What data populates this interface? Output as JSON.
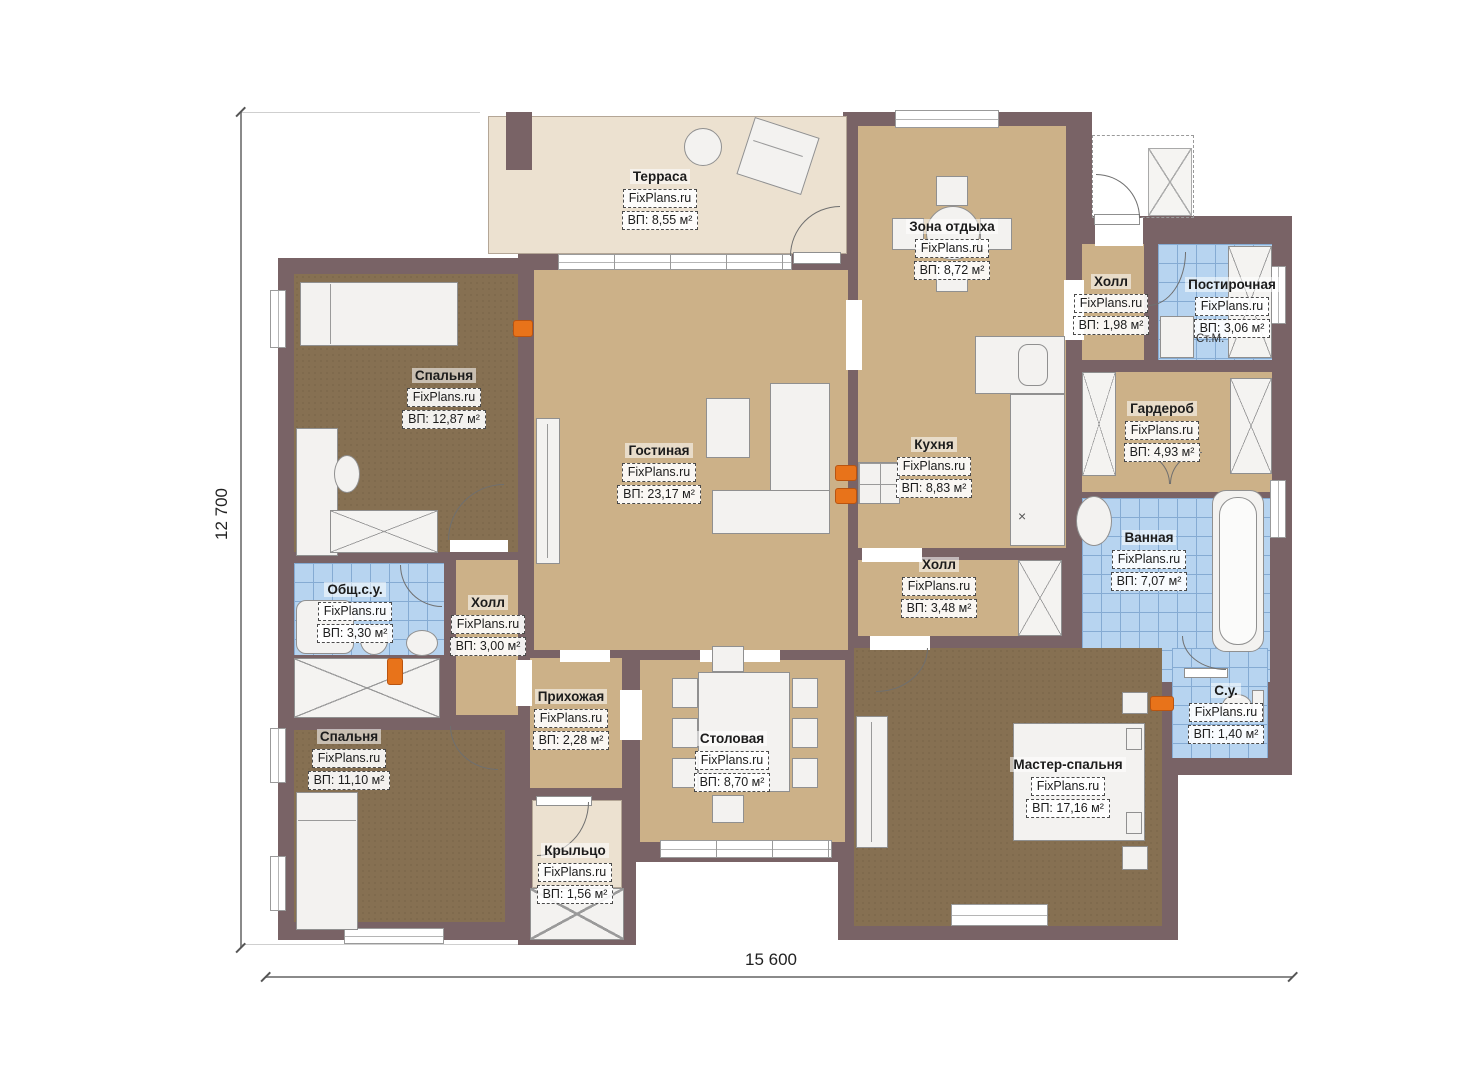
{
  "watermark": "FixPlans.ru",
  "dimensions": {
    "height": "12 700",
    "width": "15 600"
  },
  "annotations": {
    "washing_machine": "Ст.М."
  },
  "rooms": [
    {
      "name": "Терраса",
      "area": "ВП: 8,55 м²"
    },
    {
      "name": "Зона отдыха",
      "area": "ВП: 8,72 м²"
    },
    {
      "name": "Холл",
      "area": "ВП: 1,98 м²"
    },
    {
      "name": "Постирочная",
      "area": "ВП: 3,06 м²"
    },
    {
      "name": "Гардероб",
      "area": "ВП: 4,93 м²"
    },
    {
      "name": "Ванная",
      "area": "ВП: 7,07 м²"
    },
    {
      "name": "С.у.",
      "area": "ВП: 1,40 м²"
    },
    {
      "name": "Кухня",
      "area": "ВП: 8,83 м²"
    },
    {
      "name": "Холл",
      "area": "ВП: 3,48 м²"
    },
    {
      "name": "Гостиная",
      "area": "ВП: 23,17 м²"
    },
    {
      "name": "Спальня",
      "area": "ВП: 12,87 м²"
    },
    {
      "name": "Общ.с.у.",
      "area": "ВП: 3,30 м²"
    },
    {
      "name": "Холл",
      "area": "ВП: 3,00 м²"
    },
    {
      "name": "Спальня",
      "area": "ВП: 11,10 м²"
    },
    {
      "name": "Прихожая",
      "area": "ВП: 2,28 м²"
    },
    {
      "name": "Столовая",
      "area": "ВП: 8,70 м²"
    },
    {
      "name": "Крыльцо",
      "area": "ВП: 1,56 м²"
    },
    {
      "name": "Мастер-спальня",
      "area": "ВП: 17,16 м²"
    }
  ]
}
